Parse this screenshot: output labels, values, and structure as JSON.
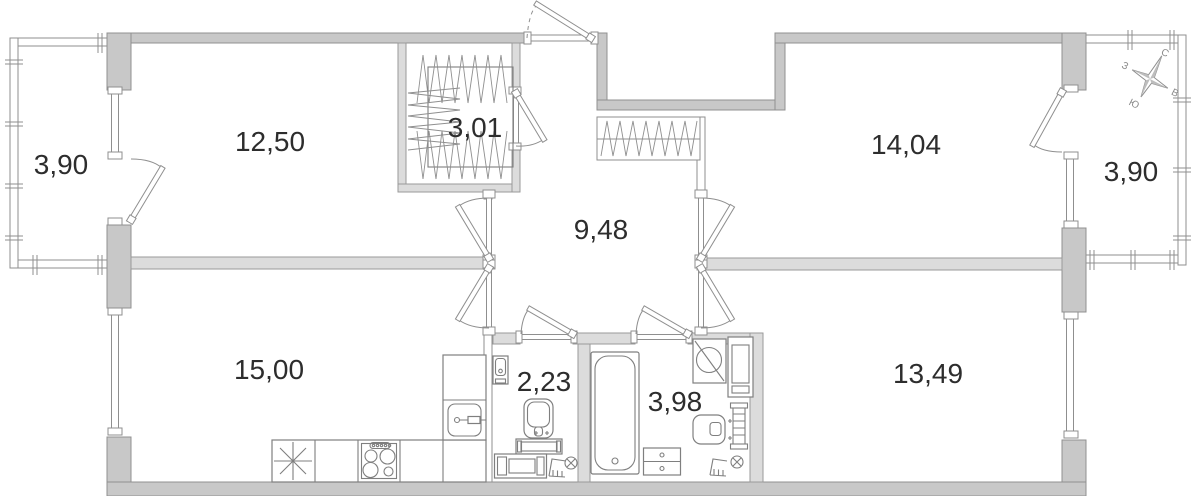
{
  "plan": {
    "rooms": [
      {
        "id": "balcony-left",
        "area": "3,90"
      },
      {
        "id": "room-top-left",
        "area": "12,50"
      },
      {
        "id": "wardrobe",
        "area": "3,01"
      },
      {
        "id": "hallway",
        "area": "9,48"
      },
      {
        "id": "room-top-right",
        "area": "14,04"
      },
      {
        "id": "balcony-right",
        "area": "3,90"
      },
      {
        "id": "room-bottom-left",
        "area": "15,00"
      },
      {
        "id": "wc",
        "area": "2,23"
      },
      {
        "id": "bathroom",
        "area": "3,98"
      },
      {
        "id": "room-bottom-right",
        "area": "13,49"
      }
    ],
    "compass": {
      "north": "С",
      "east": "В",
      "south": "Ю",
      "west": "З"
    },
    "colors": {
      "wall_outer": "#c8c8c8",
      "wall_inner": "#dcdcdc",
      "line": "#8f8f8f",
      "label_text": "#2d2d2d",
      "background": "#ffffff"
    }
  }
}
